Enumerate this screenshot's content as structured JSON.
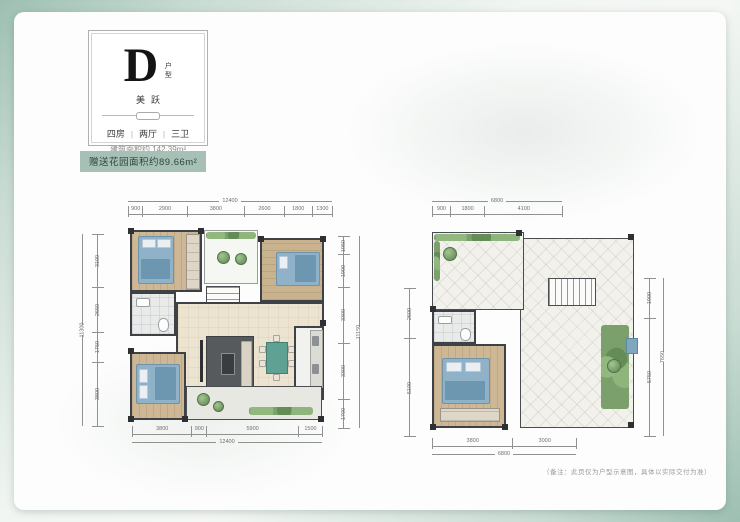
{
  "colors": {
    "frame_green": "#9dbfb2",
    "badge_bg": "#a7c0b5",
    "badge_text": "#2e4640",
    "wall": "#3e4145",
    "bed_blue": "#8fb2c8",
    "dining_teal": "#5fa294",
    "plant_green": "#7ba06c"
  },
  "type_card": {
    "letter": "D",
    "letter_suffix": "户型",
    "subtitle": "美跃",
    "specs": [
      "四房",
      "两厅",
      "三卫"
    ],
    "separator": "|",
    "area_label": "建筑面积约 142.39m²"
  },
  "badge": {
    "text": "赠送花园面积约89.66m²"
  },
  "plans": {
    "left": {
      "dims_top": {
        "total": "12400",
        "segments": [
          "900",
          "2900",
          "3800",
          "2600",
          "1800",
          "1300"
        ]
      },
      "dims_left": {
        "total": "11300",
        "segments": [
          "3100",
          "2650",
          "1750",
          "3800"
        ]
      },
      "dims_right": {
        "total": "11150",
        "segments": [
          "1050",
          "1900",
          "3300",
          "3300",
          "1700"
        ]
      },
      "dims_bottom": {
        "total": "12400",
        "segments": [
          "3800",
          "900",
          "5900",
          "1500"
        ]
      }
    },
    "right": {
      "dims_top": {
        "total": "6800",
        "segments": [
          "900",
          "1800",
          "4100"
        ]
      },
      "dims_left": {
        "segments": [
          "2600",
          "5100"
        ]
      },
      "dims_right": {
        "total": "7650",
        "segments": [
          "1900",
          "5750"
        ]
      },
      "dims_bottom": {
        "total": "6800",
        "segments": [
          "3800",
          "3000"
        ]
      }
    }
  },
  "footnote": "（备注：此页仅为户型示意图，具体以实际交付为准）"
}
